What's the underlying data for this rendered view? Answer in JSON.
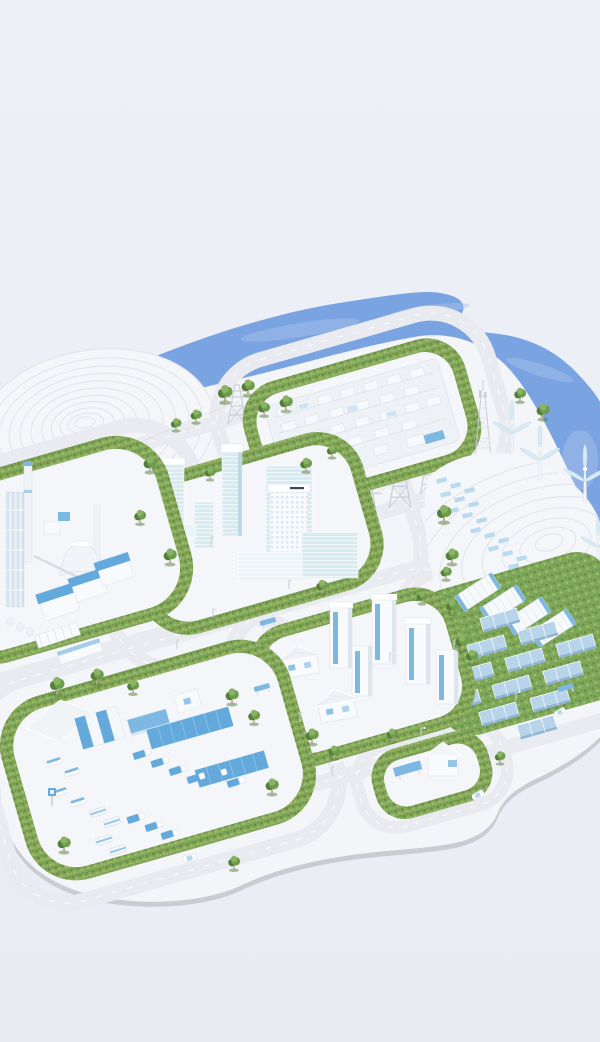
{
  "scene": {
    "kind": "isometric-3d-miniature-illustration",
    "subject": "sustainable smart-city energy park on a pale studio background",
    "regions": [
      {
        "name": "sea"
      },
      {
        "name": "terraced-contour-hill"
      },
      {
        "name": "electrical-substation-block"
      },
      {
        "name": "downtown-glass-towers-block"
      },
      {
        "name": "industrial-plant-block"
      },
      {
        "name": "telecom-lattice-tower"
      },
      {
        "name": "transmission-pylons"
      },
      {
        "name": "wind-turbine-hill"
      },
      {
        "name": "battery-storage-and-solar-farm"
      },
      {
        "name": "residential-block"
      },
      {
        "name": "logistics-depot-block"
      },
      {
        "name": "charging-station-block"
      },
      {
        "name": "ring-roads"
      }
    ],
    "counts": {
      "wind_turbines": 4,
      "battery_containers": 4,
      "solar_farm_panels": 12,
      "residential_towers": 5,
      "houses": 2,
      "transmission_pylons": 5
    }
  },
  "colors": {
    "bgTop": "#edf0f6",
    "bgBottom": "#e9edf3",
    "water": "#7aa3e1",
    "waterHighlight": "#a9c4ec",
    "platform": "#f3f5f8",
    "platformRim": "#c9ccd3",
    "pad": "#f4f6f9",
    "hill": "#f4f6f9",
    "contour": "#e1e4ea",
    "road": "#e9ebf0",
    "hedge": "#84a758",
    "hedgeDark": "#688f46",
    "hedgeLight": "#9dbb70",
    "grass": "#7ea75a",
    "glass": "#d6ebf2",
    "glassLight": "#eaf5f9",
    "glassShade": "#bcd9e8",
    "building": "#f8fafc",
    "buildingEdge": "#dde2e9",
    "buildingShade": "#dfe5ec",
    "accentBlue": "#64a9dc",
    "accentLight": "#7db8e2",
    "panelBlue": "#b7d4ea",
    "panelEdge": "#8fb4d4",
    "steel": "#c9cfd7",
    "tree": "#6d9d4c",
    "treeDark": "#527f38",
    "treeLight": "#8ab364",
    "trunk": "#b9a58e"
  }
}
